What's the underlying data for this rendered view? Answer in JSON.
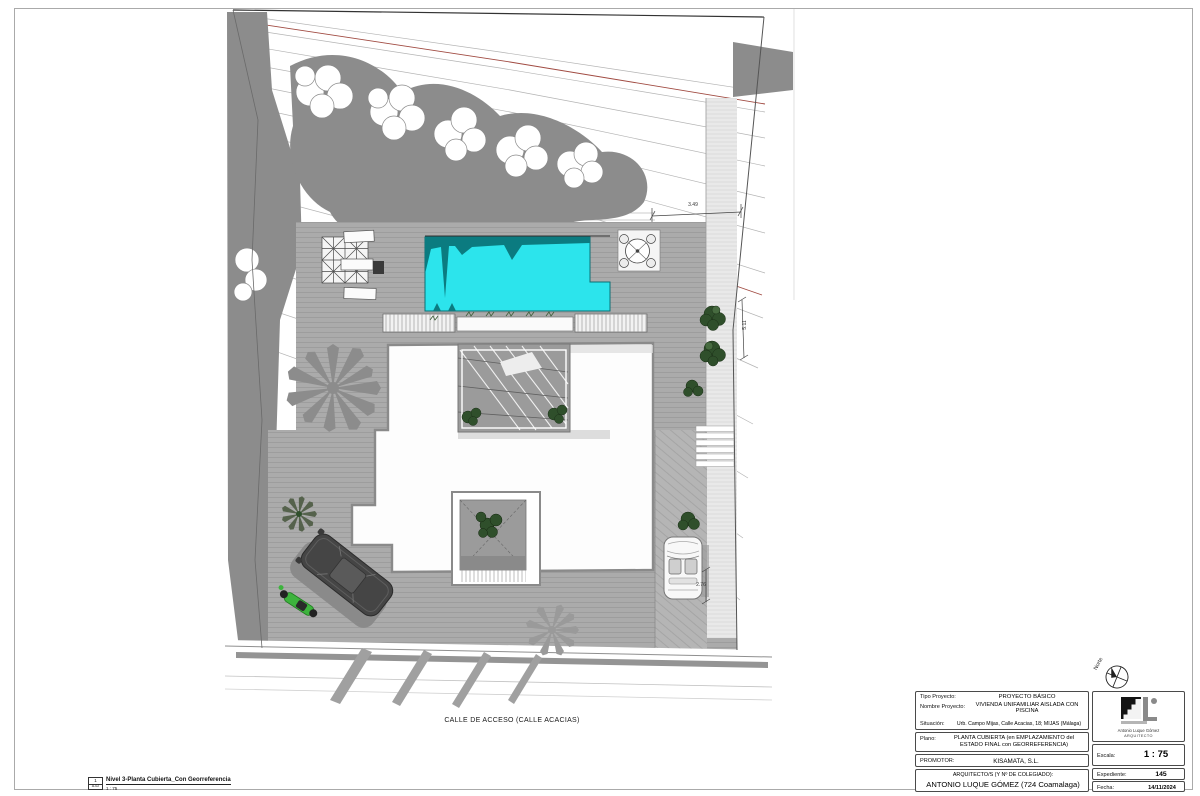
{
  "plan": {
    "street_label": "CALLE DE ACCESO (CALLE ACACIAS)",
    "north_label": "Norte",
    "dim_top": "3.49",
    "dim_right": "5.11",
    "dim_driveway": "2.76"
  },
  "legend": {
    "ref_number": "1",
    "ref_sheet": "A-02",
    "scale": "1 : 75",
    "title": "Nivel 3-Planta Cubierta_Con Georreferencia"
  },
  "title_block": {
    "rows": [
      {
        "label": "Tipo Proyecto:",
        "value": "PROYECTO BÁSICO"
      },
      {
        "label": "Nombre Proyecto:",
        "value": "VIVIENDA UNIFAMILIAR AISLADA CON PISCINA"
      },
      {
        "label": "Situación:",
        "value": "Urb. Campo Mijas, Calle Acacias, 18; MIJAS (Málaga)"
      }
    ],
    "plano_label": "Plano:",
    "plano_value": "PLANTA CUBIERTA (en EMPLAZAMIENTO del ESTADO FINAL con GEORREFERENCIA)",
    "promotor_label": "PROMOTOR:",
    "promotor_value": "KISAMATA, S.L.",
    "architect_label": "ARQUITECTO/S (Y Nº DE COLEGIADO):",
    "architect_value": "ANTONIO LUQUE GÓMEZ (724 Coamalaga)",
    "logo_name": "Antonio Luque Gómez",
    "logo_title": "ARQUITECTO",
    "escala_label": "Escala:",
    "escala_value": "1 : 75",
    "expediente_label": "Expediente:",
    "expediente_value": "145",
    "fecha_label": "Fecha:",
    "fecha_value": "14/11/2024"
  },
  "colors": {
    "pool": "#2ce4ec",
    "pool_shadow": "#0b7b80",
    "terrain_gray": "#8c8c8c",
    "deck_gray": "#ababab",
    "contour_red": "#a04a41",
    "bush_green": "#2f4f2b",
    "scooter_green": "#3db33d"
  }
}
